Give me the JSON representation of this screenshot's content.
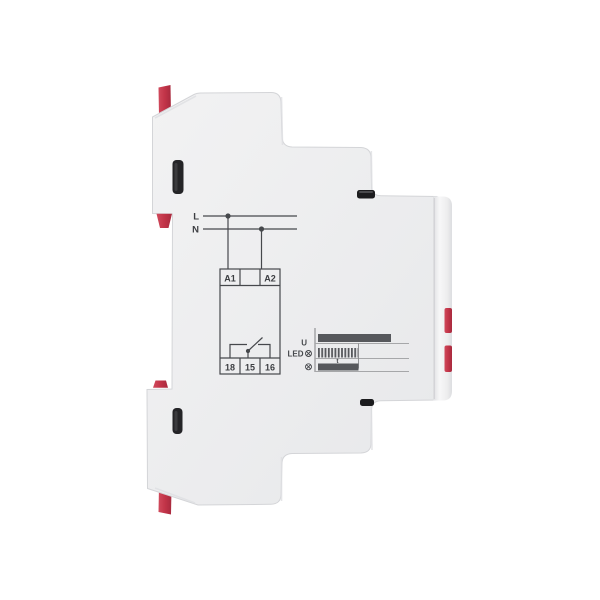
{
  "image": {
    "description": "Side view of a modular DIN-rail relay with printed wiring diagram and timing diagram",
    "background": "#ffffff"
  },
  "device": {
    "body_color": "#ebecee",
    "front_panel_color": "#f4f4f6",
    "clip_color": "#c23448",
    "slot_color": "#1f1f21",
    "outline_color": "#d4d5d8"
  },
  "wiring": {
    "line_color": "#46484c",
    "labels": {
      "l": "L",
      "n": "N",
      "a1": "A1",
      "a2": "A2",
      "t18": "18",
      "t15": "15",
      "t16": "16"
    }
  },
  "timing": {
    "bar_color": "#56585c",
    "baseline_color": "#a6a7a9",
    "labels": {
      "u": "U",
      "led": "LED",
      "t": "t"
    },
    "rows": [
      {
        "name": "supply-voltage",
        "label": "U",
        "bar": "solid, long"
      },
      {
        "name": "led-indicator",
        "label": "LED",
        "icon": "lamp-icon",
        "bar": "blinking hatched during t"
      },
      {
        "name": "output-lamp",
        "label": "",
        "icon": "lamp-icon",
        "bar": "solid during t"
      }
    ]
  }
}
